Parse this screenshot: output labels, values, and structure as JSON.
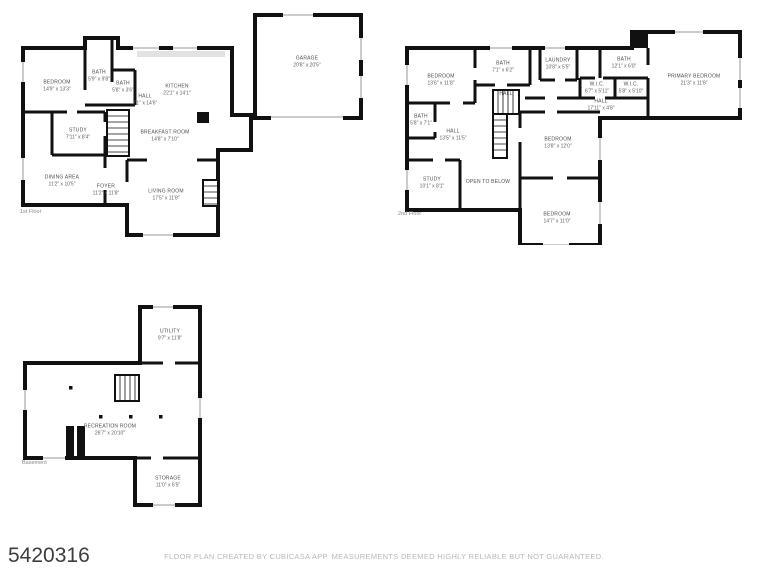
{
  "page": {
    "listing_id": "5420316",
    "disclaimer": "FLOOR PLAN CREATED BY CUBICASA APP. MEASUREMENTS DEEMED HIGHLY RELIABLE BUT NOT GUARANTEED.",
    "background_color": "#ffffff",
    "wall_color": "#111111",
    "label_color": "#4d4d4d",
    "muted_text_color": "#b8b8b8"
  },
  "floors": [
    {
      "label": "1st Floor",
      "rooms": [
        {
          "name": "BEDROOM",
          "dims": "14'9\" x 13'3\""
        },
        {
          "name": "BATH",
          "dims": "5'9\" x 9'8\""
        },
        {
          "name": "BATH",
          "dims": "5'8\" x 3'6\""
        },
        {
          "name": "KITCHEN",
          "dims": "22'1\" x 14'1\""
        },
        {
          "name": "HALL",
          "dims": "7'1\" x 14'6\""
        },
        {
          "name": "STUDY",
          "dims": "7'11\" x 8'4\""
        },
        {
          "name": "DINING AREA",
          "dims": "11'2\" x 10'5\""
        },
        {
          "name": "BREAKFAST ROOM",
          "dims": "14'8\" x 7'10\""
        },
        {
          "name": "FOYER",
          "dims": "11'2\" x 11'8\""
        },
        {
          "name": "LIVING ROOM",
          "dims": "17'5\" x 11'8\""
        },
        {
          "name": "GARAGE",
          "dims": "20'8\" x 20'5\""
        }
      ]
    },
    {
      "label": "2nd Floor",
      "rooms": [
        {
          "name": "BEDROOM",
          "dims": "13'6\" x 11'8\""
        },
        {
          "name": "BATH",
          "dims": "7'1\" x 6'2\""
        },
        {
          "name": "LAUNDRY",
          "dims": "10'8\" x 5'5\""
        },
        {
          "name": "BATH",
          "dims": "12'1\" x 6'0\""
        },
        {
          "name": "PRIMARY BEDROOM",
          "dims": "21'3\" x 11'8\""
        },
        {
          "name": "W.I.C.",
          "dims": "6'7\" x 5'11\""
        },
        {
          "name": "W.I.C.",
          "dims": "5'8\" x 5'10\""
        },
        {
          "name": "HALL",
          "dims": "17'11\" x 4'8\""
        },
        {
          "name": "HALL",
          "dims": ""
        },
        {
          "name": "BATH",
          "dims": "5'8\" x 7'1\""
        },
        {
          "name": "HALL",
          "dims": "13'5\" x 11'5\""
        },
        {
          "name": "STUDY",
          "dims": "10'1\" x 8'1\""
        },
        {
          "name": "OPEN TO BELOW",
          "dims": ""
        },
        {
          "name": "BEDROOM",
          "dims": "13'8\" x 12'0\""
        },
        {
          "name": "BEDROOM",
          "dims": "14'7\" x 11'0\""
        }
      ]
    },
    {
      "label": "Basement",
      "rooms": [
        {
          "name": "UTILITY",
          "dims": "9'7\" x 11'8\""
        },
        {
          "name": "RECREATION ROOM",
          "dims": "26'7\" x 20'10\""
        },
        {
          "name": "STORAGE",
          "dims": "11'0\" x 6'5\""
        }
      ]
    }
  ]
}
